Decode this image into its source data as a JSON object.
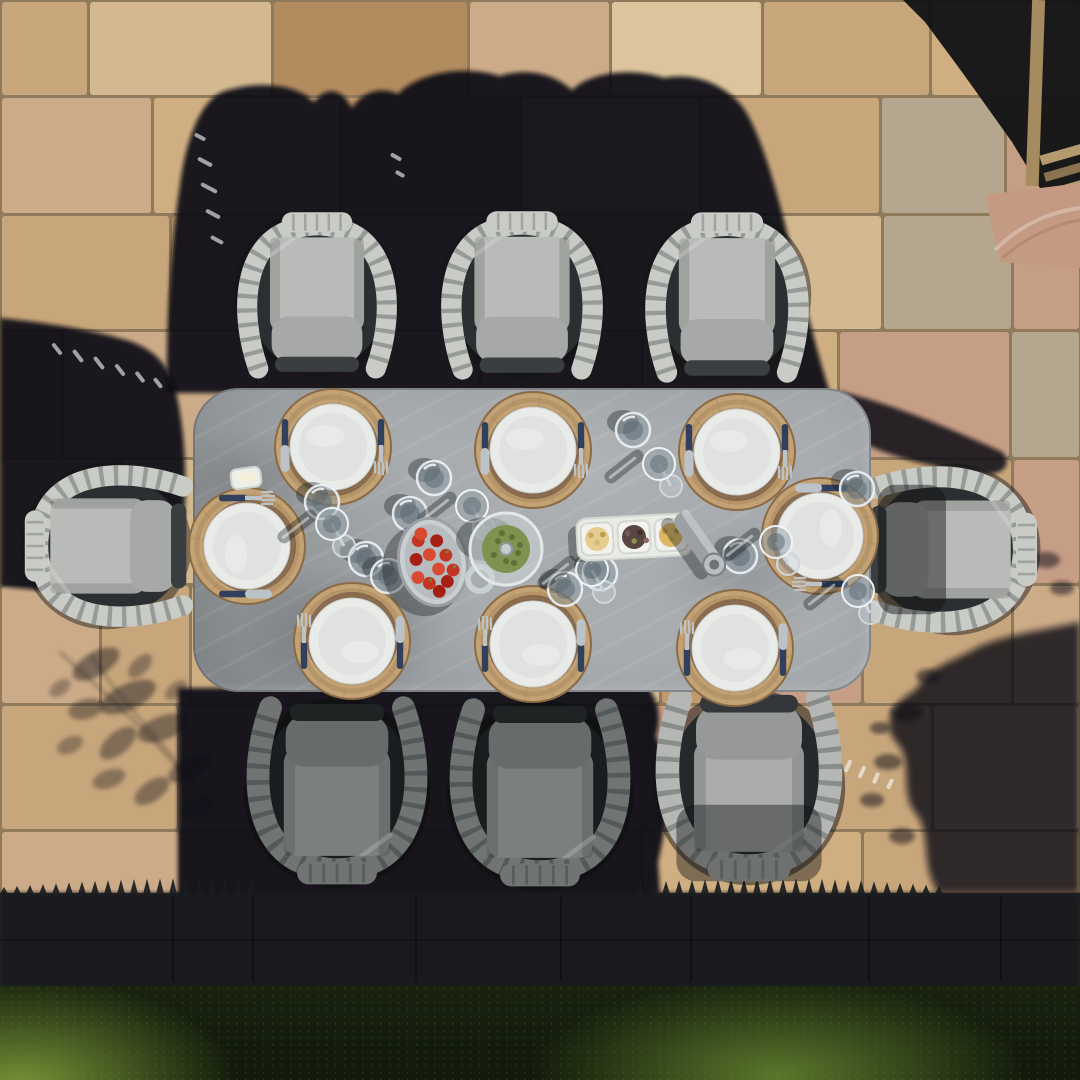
{
  "meta": {
    "alt": "Aerial top-down photograph of an eight-seat outdoor dining set: a grey stone-effect rectangular table surrounded by rope-framed armchairs with light grey cushions, standing on a sandstone paved patio. The table is laid with eight white plates on round woven rope placemats, navy-handled cutlery, tumblers and wine glasses, a bowl of strawberries, a glass infuser jug, a three-part snack tray and a grinder. Hard afternoon shadows fall to the upper left, a shadowed paving band and a hedge lawn edge run along the bottom."
  },
  "paving": {
    "grout": "#8f7a5c",
    "palette": [
      "#cfae82",
      "#dcc49c",
      "#bf9668",
      "#c8a67c",
      "#d3b890",
      "#b28b5e",
      "#c69d85",
      "#b5a78f",
      "#ccab88",
      "#c19b6d"
    ],
    "rows": [
      {
        "y": 0,
        "h": 96,
        "cells": [
          [
            0,
            88,
            3
          ],
          [
            88,
            272,
            4
          ],
          [
            272,
            468,
            5
          ],
          [
            468,
            610,
            8
          ],
          [
            610,
            762,
            1
          ],
          [
            762,
            930,
            3
          ],
          [
            930,
            1080,
            0
          ]
        ]
      },
      {
        "y": 96,
        "h": 118,
        "cells": [
          [
            0,
            152,
            8
          ],
          [
            152,
            340,
            0
          ],
          [
            340,
            520,
            2
          ],
          [
            520,
            700,
            4
          ],
          [
            700,
            880,
            3
          ],
          [
            880,
            1005,
            7
          ],
          [
            1005,
            1080,
            6
          ]
        ]
      },
      {
        "y": 214,
        "h": 116,
        "cells": [
          [
            0,
            170,
            3
          ],
          [
            170,
            330,
            9
          ],
          [
            330,
            520,
            8
          ],
          [
            520,
            705,
            0
          ],
          [
            705,
            882,
            4
          ],
          [
            882,
            1012,
            7
          ],
          [
            1012,
            1080,
            6
          ]
        ]
      },
      {
        "y": 330,
        "h": 128,
        "cells": [
          [
            0,
            62,
            5
          ],
          [
            62,
            255,
            8
          ],
          [
            255,
            480,
            3
          ],
          [
            480,
            642,
            9
          ],
          [
            642,
            838,
            0
          ],
          [
            838,
            1010,
            6
          ],
          [
            1010,
            1080,
            7
          ]
        ]
      },
      {
        "y": 458,
        "h": 126,
        "cells": [
          [
            0,
            120,
            0
          ],
          [
            120,
            305,
            4
          ],
          [
            305,
            500,
            8
          ],
          [
            500,
            660,
            3
          ],
          [
            660,
            845,
            9
          ],
          [
            845,
            1012,
            3
          ],
          [
            1012,
            1080,
            6
          ]
        ]
      },
      {
        "y": 584,
        "h": 120,
        "cells": [
          [
            0,
            100,
            8
          ],
          [
            100,
            190,
            3
          ],
          [
            190,
            400,
            0
          ],
          [
            400,
            660,
            4
          ],
          [
            660,
            702,
            9
          ],
          [
            702,
            862,
            6
          ],
          [
            862,
            1012,
            3
          ],
          [
            1012,
            1080,
            8
          ]
        ]
      },
      {
        "y": 704,
        "h": 126,
        "cells": [
          [
            0,
            178,
            3
          ],
          [
            178,
            420,
            8
          ],
          [
            420,
            642,
            0
          ],
          [
            642,
            760,
            6
          ],
          [
            760,
            932,
            3
          ],
          [
            932,
            1080,
            8
          ]
        ]
      },
      {
        "y": 830,
        "h": 64,
        "cells": [
          [
            0,
            180,
            8
          ],
          [
            180,
            400,
            3
          ],
          [
            400,
            642,
            9
          ],
          [
            642,
            862,
            0
          ],
          [
            862,
            1080,
            3
          ]
        ]
      }
    ]
  },
  "band": {
    "color": "#191c1e",
    "lineColor": "rgba(5,6,8,0.5)",
    "lines": [
      172,
      252,
      415,
      560,
      690,
      868,
      1000
    ],
    "y": 893,
    "h": 95
  },
  "grass": {
    "base": "#18220f",
    "deep": "#121a0b",
    "litLeft": "rgba(134,168,62,0.85)",
    "litMid": "rgba(108,142,52,0.8)",
    "y": 986,
    "h": 94
  },
  "shadows": {
    "blob": "#0e1013",
    "leaf": "#15181a",
    "mark": "rgba(245,248,245,0.62)"
  },
  "table": {
    "x": 193,
    "y": 388,
    "w": 678,
    "h": 304,
    "r": 46,
    "fill": "#a8acaf"
  },
  "chairPalettes": {
    "lit": {
      "rope": "#c9cbc7",
      "gap": "#8b8f8c",
      "back": "#b9bbb8",
      "seat": "#a6a9a7",
      "front": "#3a3e41",
      "well": "#2c2f31",
      "halo": "rgba(18,20,22,0.45)"
    },
    "lit2": {
      "rope": "#b4b7b3",
      "gap": "#7e827f",
      "back": "#a9acaa",
      "seat": "#969997",
      "front": "#33373a",
      "well": "#26292b",
      "halo": "rgba(16,18,20,0.5)"
    },
    "shade": {
      "rope": "#70757 3",
      "gap": "#4e5352",
      "back": "#7b807e",
      "seat": "#676c6a",
      "front": "#202324",
      "well": "#1a1d1f",
      "halo": "rgba(12,14,15,0.55)"
    }
  },
  "chairs": [
    {
      "id": "chair-top-left",
      "x": 317,
      "y": 289,
      "rot": 0,
      "w": 168,
      "h": 205,
      "pal": "lit",
      "overlay": "none"
    },
    {
      "id": "chair-top-middle",
      "x": 522,
      "y": 289,
      "rot": 0,
      "w": 170,
      "h": 205,
      "pal": "lit",
      "overlay": "none"
    },
    {
      "id": "chair-top-right",
      "x": 727,
      "y": 291,
      "rot": 0,
      "w": 172,
      "h": 205,
      "pal": "lit",
      "overlay": "none"
    },
    {
      "id": "chair-left-end",
      "x": 103,
      "y": 546,
      "rot": -90,
      "w": 170,
      "h": 200,
      "pal": "lit",
      "overlay": "none"
    },
    {
      "id": "chair-right-end",
      "x": 956,
      "y": 549,
      "rot": 90,
      "w": 175,
      "h": 205,
      "pal": "lit",
      "overlay": "mid"
    },
    {
      "id": "chair-bottom-left",
      "x": 337,
      "y": 797,
      "rot": 180,
      "w": 190,
      "h": 210,
      "pal": "shade",
      "overlay": "none"
    },
    {
      "id": "chair-bottom-middle",
      "x": 540,
      "y": 799,
      "rot": 180,
      "w": 190,
      "h": 210,
      "pal": "shade",
      "overlay": "none"
    },
    {
      "id": "chair-bottom-right",
      "x": 749,
      "y": 791,
      "rot": 180,
      "w": 198,
      "h": 208,
      "pal": "lit2",
      "overlay": "top"
    }
  ],
  "settings": {
    "list": [
      {
        "x": 333,
        "y": 447,
        "rot": 0
      },
      {
        "x": 533,
        "y": 450,
        "rot": 0
      },
      {
        "x": 737,
        "y": 452,
        "rot": 0
      },
      {
        "x": 352,
        "y": 641,
        "rot": 180
      },
      {
        "x": 533,
        "y": 644,
        "rot": 180
      },
      {
        "x": 735,
        "y": 648,
        "rot": 180
      },
      {
        "x": 247,
        "y": 546,
        "rot": -90
      },
      {
        "x": 820,
        "y": 536,
        "rot": 90
      }
    ],
    "placemat": {
      "r": 58,
      "fill": "#c3a376",
      "ring": "#a98a5c",
      "edge": "#8a6b46"
    },
    "plate": {
      "r": 43,
      "rim": "#e9ebe9",
      "inner": "#e0e2e1",
      "underRing": "#53392c"
    },
    "cutlery": {
      "handle": "#31405e",
      "metal": "#bcc3c8",
      "offset": 48
    }
  },
  "glassware": {
    "tumblerFill": "rgba(140,155,165,0.45)",
    "tumblerRim": "rgba(236,243,247,0.9)",
    "tumblerCore": "rgba(88,102,112,0.5)",
    "wineFill": "rgba(150,162,170,0.5)",
    "wineRim": "rgba(242,247,250,0.95)",
    "stem": "#cfd6da",
    "shadow": "rgba(18,22,26,0.35)",
    "tumblers": [
      [
        434,
        478
      ],
      [
        410,
        514
      ],
      [
        633,
        430
      ],
      [
        565,
        589
      ],
      [
        740,
        556
      ],
      [
        322,
        502
      ],
      [
        366,
        559
      ],
      [
        388,
        576
      ],
      [
        857,
        489
      ],
      [
        600,
        573
      ]
    ],
    "wines": [
      [
        472,
        506
      ],
      [
        659,
        464
      ],
      [
        592,
        570
      ],
      [
        776,
        542
      ],
      [
        332,
        524
      ],
      [
        858,
        591
      ]
    ]
  },
  "centerpieces": {
    "strawberryDish": {
      "x": 433,
      "y": 562,
      "rot": -12,
      "dish": "#c9ced1",
      "dishEdge": "#9aa0a4",
      "inner": "#b6bcbf",
      "berry": [
        "#c23424",
        "#a61f14",
        "#d84a32"
      ],
      "leaf": "#6a8a3a"
    },
    "jug": {
      "x": 506,
      "y": 549,
      "glass": "rgba(205,213,215,0.55)",
      "rim": "#e3e8ea",
      "herb": "#7f9351",
      "herbDark": "#5d7239",
      "knob": "#c6cdd0"
    },
    "snackTray": {
      "x": 634,
      "y": 537,
      "rot": -3,
      "base": "#e9ebe6",
      "cup": "#f2f3ef",
      "edge": "#d5d7d1",
      "contents": [
        {
          "fill": "#e4cd8e",
          "dots": [
            "#caa75f",
            "#d9b973",
            "#bf9b55"
          ]
        },
        {
          "fill": "#5a4640",
          "dots": [
            "#7c5a63",
            "#88914e",
            "#402f2b",
            "#93646b"
          ]
        },
        {
          "fill": "#dcb964",
          "dots": [
            "#bf9a41",
            "#cfa94e",
            "#b38f39"
          ]
        }
      ]
    },
    "grinder": {
      "x": 697,
      "y": 540,
      "rot": 55,
      "body": "#9aa0a3",
      "hi": "rgba(255,255,255,0.35)",
      "cap": "#b8bec1",
      "capEdge": "#787e81",
      "core": "#6d7376"
    },
    "butterDish": {
      "x": 246,
      "y": 478,
      "rot": -8,
      "fill": "#eceee9",
      "edge": "#cdd0ca"
    }
  },
  "structure": {
    "shadowFill": "#101214",
    "wood1": "#a68a60",
    "wood2": "#b59a6e",
    "wood3": "#8a7350",
    "pinkStone": "#c59a82"
  },
  "shadowMarks": [
    [
      205,
      162,
      -62,
      16
    ],
    [
      209,
      188,
      -62,
      18
    ],
    [
      213,
      214,
      -62,
      16
    ],
    [
      217,
      240,
      -62,
      14
    ],
    [
      200,
      137,
      -62,
      12
    ],
    [
      396,
      157,
      -60,
      12
    ],
    [
      400,
      174,
      -60,
      10
    ],
    [
      57,
      349,
      -38,
      14
    ],
    [
      78,
      356,
      -38,
      15
    ],
    [
      99,
      363,
      -38,
      15
    ],
    [
      120,
      370,
      -38,
      14
    ],
    [
      140,
      377,
      -38,
      13
    ],
    [
      158,
      383,
      -38,
      12
    ],
    [
      848,
      766,
      24,
      13
    ],
    [
      862,
      772,
      24,
      13
    ],
    [
      876,
      778,
      24,
      12
    ],
    [
      890,
      784,
      24,
      11
    ]
  ]
}
